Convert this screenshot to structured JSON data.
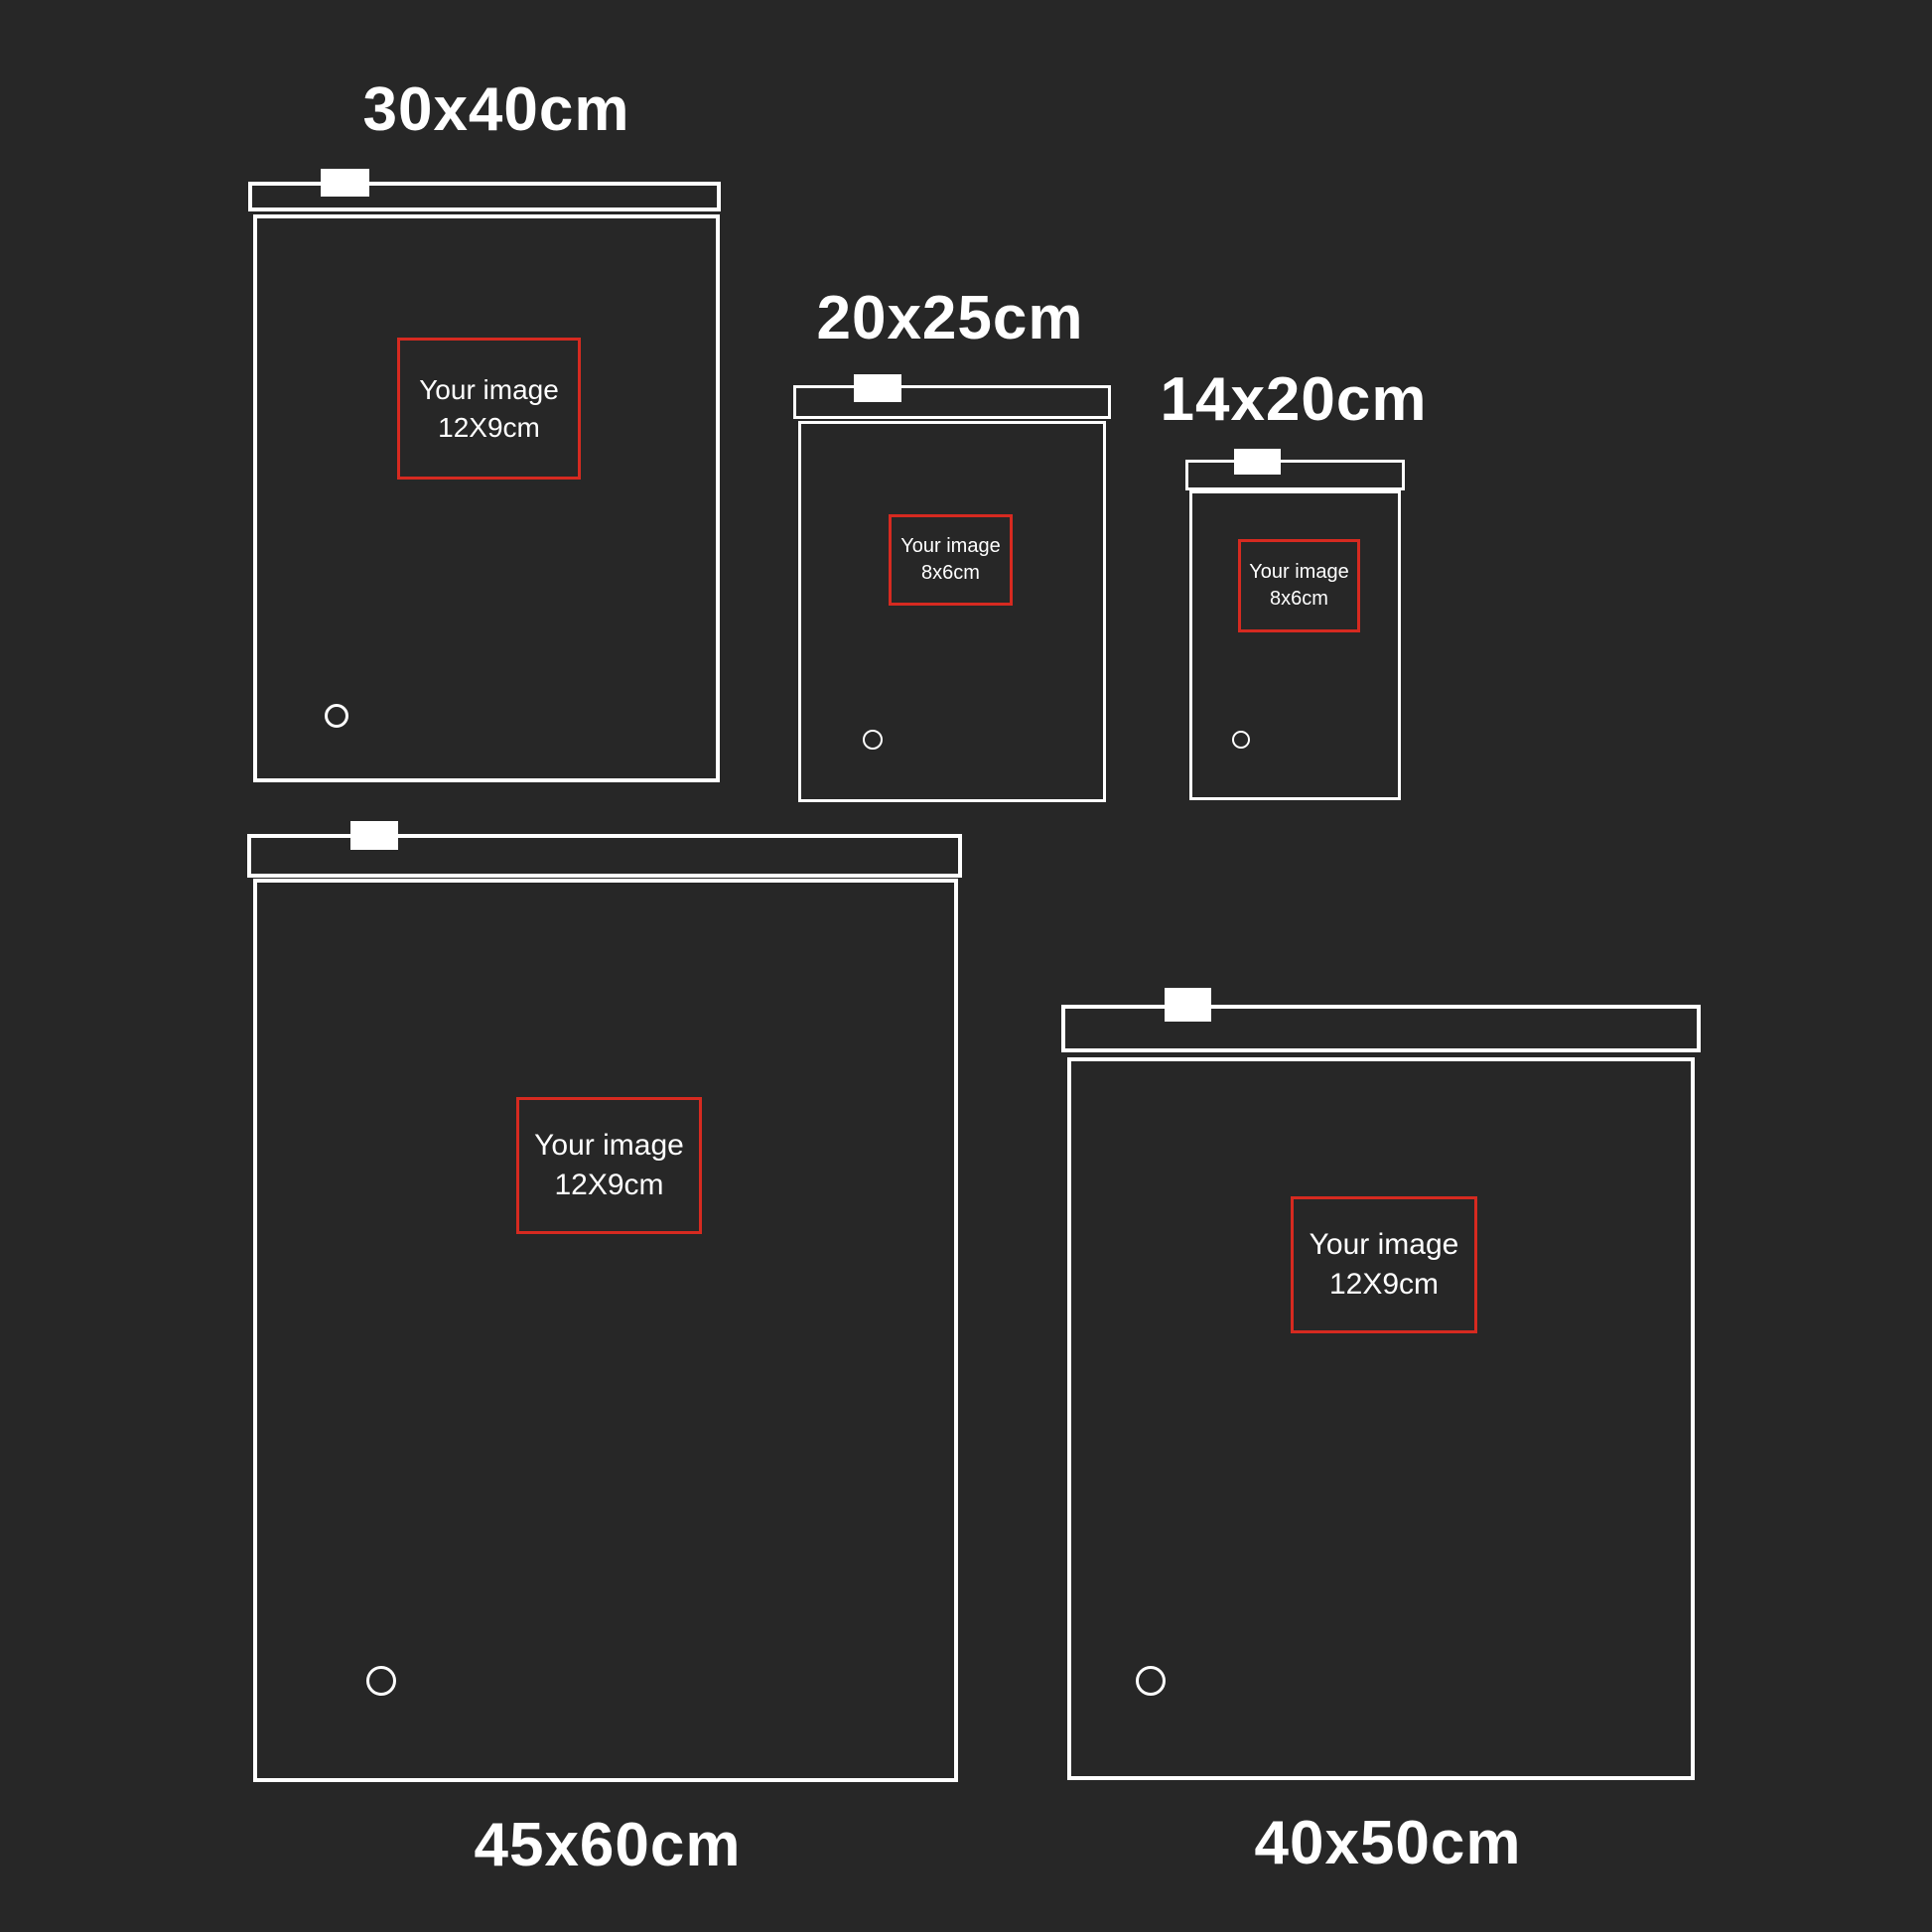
{
  "colors": {
    "background": "#272727",
    "line": "#ffffff",
    "accent_red": "#d62a20"
  },
  "bags": [
    {
      "size_label": "30x40cm",
      "image_line1": "Your image",
      "image_line2": "12X9cm"
    },
    {
      "size_label": "20x25cm",
      "image_line1": "Your image",
      "image_line2": "8x6cm"
    },
    {
      "size_label": "14x20cm",
      "image_line1": "Your image",
      "image_line2": "8x6cm"
    },
    {
      "size_label": "45x60cm",
      "image_line1": "Your image",
      "image_line2": "12X9cm"
    },
    {
      "size_label": "40x50cm",
      "image_line1": "Your image",
      "image_line2": "12X9cm"
    }
  ]
}
